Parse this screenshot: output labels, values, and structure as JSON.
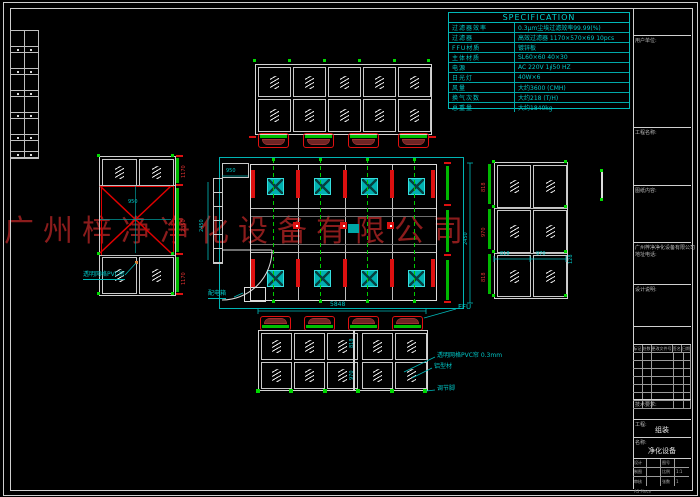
{
  "watermark": {
    "text": "广州梓净净化设备有限公司",
    "color": "#8b1c1c"
  },
  "spec": {
    "title": "SPECIFICATION",
    "rows": [
      {
        "label": "过滤器效率",
        "value": "0.3μm尘埃过滤效率99.99(%)"
      },
      {
        "label": "过滤器",
        "value": "高效过滤器 1170×570×69 10pcs"
      },
      {
        "label": "FFU材质",
        "value": "镀锌板"
      },
      {
        "label": "主体材质",
        "value": "SL60×60  40×30"
      },
      {
        "label": "电源",
        "value": "AC 220V 1∮50 HZ"
      },
      {
        "label": "日光灯",
        "value": "40W×6"
      },
      {
        "label": "风量",
        "value": "大约3600 (CMH)"
      },
      {
        "label": "换气次数",
        "value": "大约218 (T/H)"
      },
      {
        "label": "总重量",
        "value": "大约1840kg"
      }
    ]
  },
  "labels": {
    "ffu": "FFU",
    "pvc_curtain": "透明网格PVC帘 0.3mm",
    "alu_profile": "铝型材",
    "foot": "调节脚",
    "power_box": "配电箱",
    "left_panel": "透明网格PVC帘"
  },
  "dims": {
    "total_width": "5848",
    "re_a": "818",
    "re_b": "970",
    "re_side": "128",
    "le_v1": "1170",
    "le_v2": "2350",
    "le_v3": "1170",
    "le_center": "950",
    "rl_1": "818",
    "rl_2": "970",
    "rl_3": "818",
    "be_v1": "818",
    "be_v2": "970",
    "plan_top": "950",
    "plan_left": "2450",
    "plan_right": "2450"
  },
  "title_block": {
    "s1": "用户单位:",
    "s2": "工程名称:",
    "s3": "图纸内容:",
    "s4a": "广州梓净净化设备有限公司",
    "s4b": "地址电话:",
    "s5": "设计说明:",
    "rev_headers": [
      "标记",
      "处数",
      "更改文件号",
      "签名",
      "日期"
    ],
    "s6": "技术要求:",
    "proj_label": "工程:",
    "proj_value": "组装",
    "name_label": "名称:",
    "name_value": "净化设备",
    "grid": [
      [
        "设计",
        "",
        "图号",
        ""
      ],
      [
        "制图",
        "",
        "比例",
        "1:1"
      ],
      [
        "审核",
        "",
        "张数",
        "1"
      ]
    ],
    "footer": "A3  Piece"
  }
}
